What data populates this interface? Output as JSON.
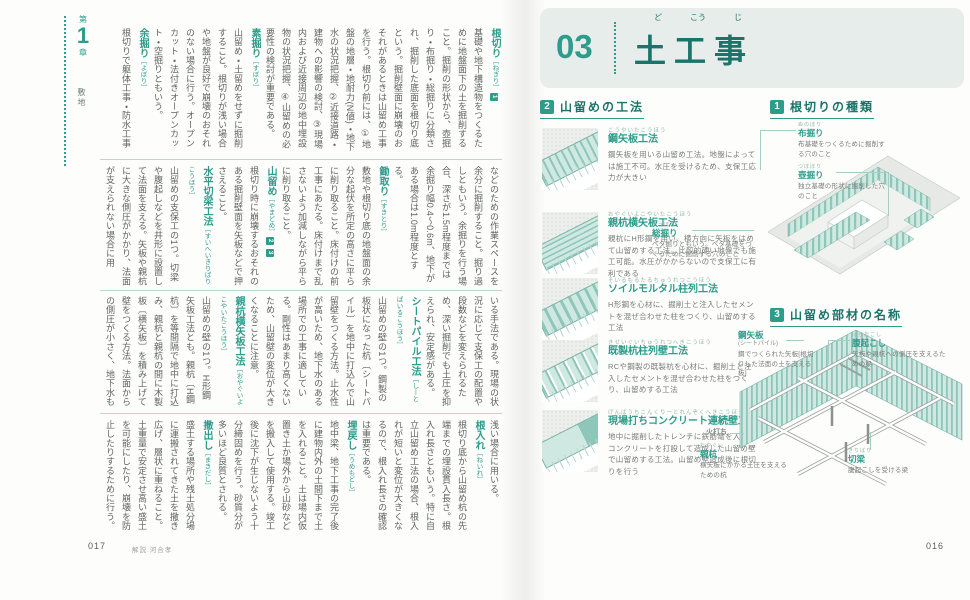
{
  "accent_color": "#2e9c8b",
  "left_page": {
    "chapter": {
      "prefix": "第",
      "number": "1",
      "suffix": "章",
      "section": "敷地"
    },
    "footer": {
      "page_number": "017",
      "credit": "解説:河合孝"
    },
    "bands": [
      {
        "segments": [
          {
            "kind": "term",
            "text": "根切り",
            "reading": "ねぎり",
            "badges": [
              "1"
            ]
          },
          {
            "kind": "body",
            "text": "基礎や地下構造物をつくるために地盤面下の土を掘削すること。掘削の形状から、壺掘り・布掘り・総掘りに分類され、掘削した底面を根切り底という。掘削壁面に崩壊のおそれがあるときは山留め工事を行う。根切り前には、①地盤の地層・地耐力(N値)・地下水の状況把握、②近接道路・建物への影響の検討、③現場内および近接周辺の地中埋設物の状況把握、④山留めの必要性の検討が重要である。"
          },
          {
            "kind": "term",
            "text": "素掘り",
            "reading": "すぼり"
          },
          {
            "kind": "body",
            "text": "山留め・土留めをせずに掘削すること。根切りが浅い場合や地盤が良好で崩壊のおそれのない場合に行う。オープンカット・法付きオープンカット・空掘りともいう。"
          },
          {
            "kind": "term",
            "text": "余掘り",
            "reading": "よぼり"
          },
          {
            "kind": "body",
            "text": "根切りで躯体工事・防水工事"
          }
        ]
      },
      {
        "segments": [
          {
            "kind": "body",
            "text": "などのための作業スペースを余分に掘削すること。掘り過しともいう。余掘りを行う場合、深さが1.5m程度までは余掘り幅0.4〜0.6m、地下がある場合は1.0m程度とする。"
          },
          {
            "kind": "term",
            "text": "鋤取り",
            "reading": "すきとり"
          },
          {
            "kind": "body",
            "text": "敷地や根切り底の地盤面の余分な起伏を所定の高さに平らに削り取ること。床付けの前工事にあたる。床付けまで乱さないよう加減しながら平らに削り取ること。"
          },
          {
            "kind": "term",
            "text": "山留め",
            "reading": "やまどめ",
            "badges": [
              "2",
              "3"
            ]
          },
          {
            "kind": "body",
            "text": "根切り時に崩壊するおそれのある掘削壁面を矢板などで押さえること。"
          },
          {
            "kind": "term",
            "text": "水平切梁工法",
            "reading": "すいへいきりばりこうほう"
          },
          {
            "kind": "body",
            "text": "山留めの支保工の1つ。切梁や腹起しなどを井形に設置して法面を支える。矢板や親杭に大きな側圧がかかり、法面が支えられない場合に用"
          }
        ]
      },
      {
        "segments": [
          {
            "kind": "body",
            "text": "いる手法である。現場の状況に応じて支保工の配置や段数などを変えられるため、深い掘削でも土圧を抑えられ、安定感がある。"
          },
          {
            "kind": "term",
            "text": "シートパイル工法",
            "reading": "しーとぱいるこうほう"
          },
          {
            "kind": "body",
            "text": "山留めの壁の1つ。鋼製の板状になった杭〔シートパイル〕を地中に打込んで山留壁をつくる方法。止水性が高いため、地下水のある場所での工事に適している。剛性はあまり高くないため、山留壁の変位が大きくなることに注意。"
          },
          {
            "kind": "term",
            "text": "親杭横矢板工法",
            "reading": "おやぐいよこやいたこうほう"
          },
          {
            "kind": "body",
            "text": "山留めの壁の1つ。H形鋼矢板工法とも。親杭〔H鋼杭〕を等間隔で地中に打込み、親杭と親杭の間に木製板〔横矢板〕を積み上げて壁をつくる方法。法面からの側圧が小さく、地下水も少なく、掘削も比較的"
          }
        ]
      },
      {
        "segments": [
          {
            "kind": "body",
            "text": "浅い場合に用いる。"
          },
          {
            "kind": "term",
            "text": "根入れ",
            "reading": "ねいれ"
          },
          {
            "kind": "body",
            "text": "根切り底から山留め杭の先端までの埋設貫入長さ。根入れ長さともいう。特に自立山留め工法の場合、根入れが短いと変位が大きくなるので、根入れ長さの確認は重要である。"
          },
          {
            "kind": "term",
            "text": "埋戻し",
            "reading": "うめもどし"
          },
          {
            "kind": "body",
            "text": "地中梁、地下工事の完了後に建物内外の土間下まで土を入れること。土は場内仮置き土か場外から山砂などを搬入して使用する。竣工後に沈下が生じないよう十分締固めを行う。砂質分が多いほど良質とされる。"
          },
          {
            "kind": "term",
            "text": "撒出し",
            "reading": "まきだし"
          },
          {
            "kind": "body",
            "text": "盛土する場所や残土処分場に運搬されてきた土を撒き広げ、層状に重ねること。土重量で安定させ高い盛土を可能にしたり、崩壊を防止したりするために行う。"
          }
        ]
      }
    ]
  },
  "right_page": {
    "header": {
      "number": "03",
      "title": "土工事",
      "furigana": [
        "ど",
        "こう",
        "じ"
      ]
    },
    "footer": {
      "page_number": "016"
    },
    "sections": {
      "methods": {
        "badge": "2",
        "title": "山留めの工法",
        "items": [
          {
            "name": "鋼矢板工法",
            "reading": "こうやいたこうほう",
            "illus": "sheet-pile",
            "desc": "鋼矢板を用いる山留め工法。地盤によっては施工不可。水圧を受けるため、支保工応力が大きい"
          },
          {
            "name": "親杭横矢板工法",
            "reading": "おやぐいよこやいたこうほう",
            "illus": "lagging",
            "desc": "親杭にH形鋼を用い、横方向に矢板をはめて山留めする工法。比較的硬い地盤でも施工可能。水圧がかからないので支保工に有利である"
          },
          {
            "name": "ソイルモルタル柱列工法",
            "reading": "そいるもるたるちゅうれつこうほう",
            "illus": "soil-columns",
            "desc": "H形鋼を心材に、掘削土と注入したセメントを混ぜ合わせた柱をつくり、山留めする工法"
          },
          {
            "name": "既製杭柱列壁工法",
            "reading": "きせいぐいちゅうれつへきこうほう",
            "illus": "pile-row",
            "desc": "RCや鋼製の既製杭を心材に、掘削土と注入したセメントを混ぜ合わせた柱をつくり、山留めする工法"
          },
          {
            "name": "現場打ちコンクリート連続壁工法",
            "reading": "げんばうちこんくりーとれんぞくへきこうほう",
            "illus": "diaphragm",
            "desc": "地中に掘削したトレンチに鉄筋篭を入れ、コンクリートを打設して造成した山留め壁で山留めする工法。山留め壁造成後に根切りを行う"
          }
        ]
      },
      "negiri": {
        "badge": "1",
        "title": "根切りの種類",
        "labels": [
          {
            "term": "布掘り",
            "reading": "ぬのぼり",
            "desc": "布基礎をつくるために掘削する穴のこと"
          },
          {
            "term": "壺掘り",
            "reading": "つぼぼり",
            "desc": "独立基礎の形状に掘削した穴のこと"
          },
          {
            "term": "総掘り",
            "reading": "そうぼり",
            "desc": "ベタ掘りともいう。ベタ基礎をつくるために掘削する穴のこと"
          }
        ]
      },
      "parts": {
        "badge": "3",
        "title": "山留め部材の名称",
        "labels": [
          {
            "term": "鋼矢板",
            "sub": "(シートパイル)",
            "desc": "鋼でつくられた矢板[根切りした法面の土を支える板]"
          },
          {
            "term": "腹起こし",
            "reading": "はらおこし",
            "desc": "矢板や親杭への側圧を支えるための梁"
          },
          {
            "term": "火打ち",
            "desc": ""
          },
          {
            "term": "親杭",
            "reading": "おやぐい",
            "desc": "横矢板にかかる土圧を支えるための杭"
          },
          {
            "term": "切梁",
            "reading": "きりばり",
            "desc": "腹起こしを受ける梁"
          }
        ]
      }
    }
  }
}
